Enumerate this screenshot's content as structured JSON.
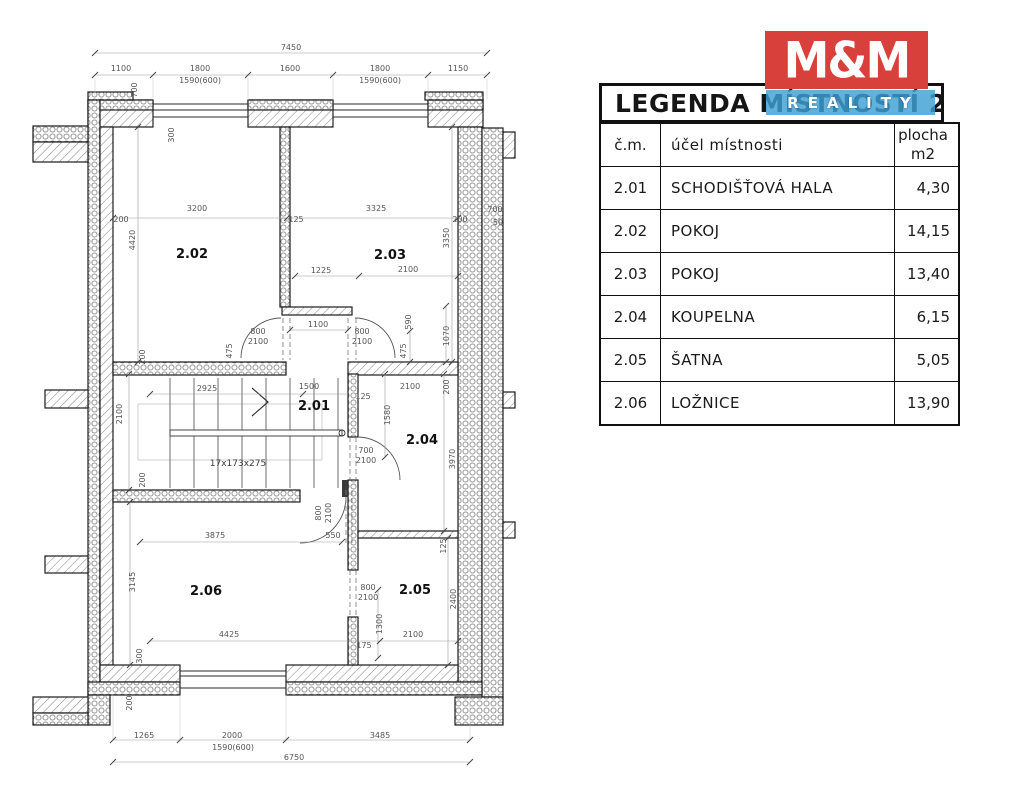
{
  "logo": {
    "brand": "M&M",
    "sub": "REALITY",
    "red": "#d8403c",
    "blue": "#3ea0d6"
  },
  "legend": {
    "title": "LEGENDA MÍSTNOSTÍ 2.NP",
    "header": {
      "col1": "č.m.",
      "col2": "účel místnosti",
      "col3a": "plocha",
      "col3b": "m2"
    },
    "rows": [
      {
        "num": "2.01",
        "name": "SCHODIŠŤOVÁ HALA",
        "area": "4,30"
      },
      {
        "num": "2.02",
        "name": "POKOJ",
        "area": "14,15"
      },
      {
        "num": "2.03",
        "name": "POKOJ",
        "area": "13,40"
      },
      {
        "num": "2.04",
        "name": "KOUPELNA",
        "area": "6,15"
      },
      {
        "num": "2.05",
        "name": "ŠATNA",
        "area": "5,05"
      },
      {
        "num": "2.06",
        "name": "LOŽNICE",
        "area": "13,90"
      }
    ]
  },
  "plan": {
    "rooms": [
      {
        "id": "2.01"
      },
      {
        "id": "2.02"
      },
      {
        "id": "2.03"
      },
      {
        "id": "2.04"
      },
      {
        "id": "2.05"
      },
      {
        "id": "2.06"
      }
    ],
    "stairs_label": "17x173x275",
    "dims": [
      "7450",
      "1100",
      "1800",
      "1600",
      "1800",
      "1150",
      "1590(600)",
      "1590(600)",
      "700",
      "300",
      "200",
      "3200",
      "125",
      "3325",
      "200",
      "700",
      "50",
      "4420",
      "3350",
      "1225",
      "2100",
      "590",
      "1070",
      "1100",
      "800",
      "2100",
      "800",
      "2100",
      "475",
      "475",
      "200",
      "2925",
      "1500",
      "125",
      "2100",
      "200",
      "2100",
      "1580",
      "17x173x275",
      "700",
      "2100",
      "3970",
      "200",
      "800",
      "2100",
      "3875",
      "550",
      "125",
      "3145",
      "800",
      "2100",
      "1300",
      "2400",
      "4425",
      "2100",
      "175",
      "300",
      "200",
      "1265",
      "2000",
      "1590(600)",
      "3485",
      "6750"
    ]
  }
}
